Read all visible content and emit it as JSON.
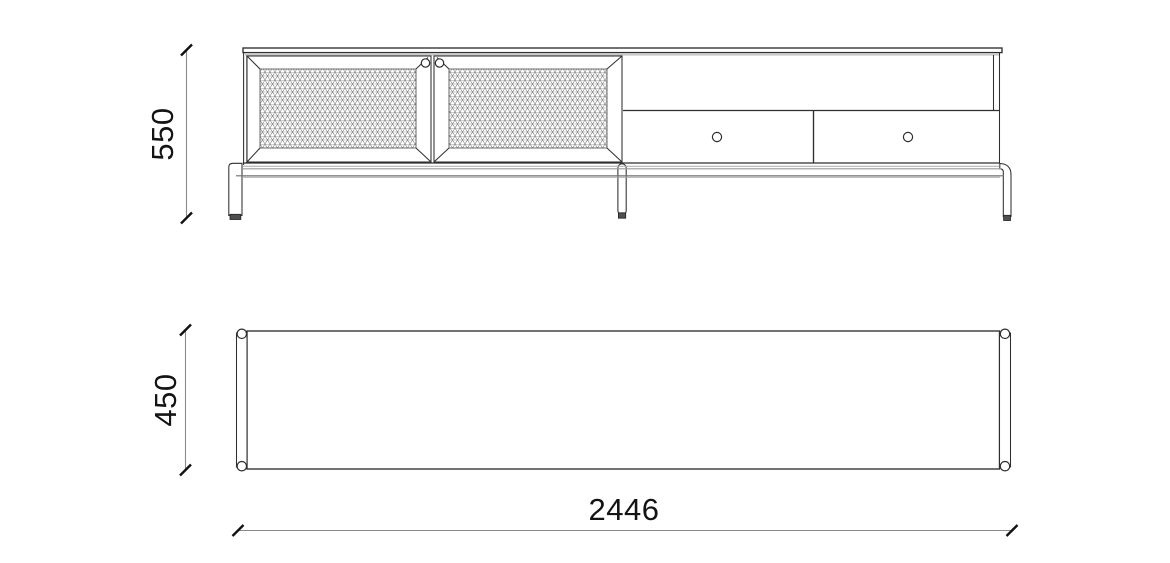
{
  "diagram": {
    "type": "furniture-technical-drawing",
    "views": {
      "front_elevation": {
        "name": "front elevation",
        "height_dimension": "550"
      },
      "plan": {
        "name": "top plan view",
        "depth_dimension": "450",
        "width_dimension": "2446"
      }
    },
    "colors": {
      "background": "#ffffff",
      "line_dark": "#2f2f2f",
      "line_medium": "#6f6f6f",
      "line_light": "#a9a9a9",
      "rail_top": "#9a9a9a",
      "dimension_line": "#8a8a8a",
      "tick": "#111111",
      "text": "#141414",
      "foot_cap": "#4f4f4f"
    }
  }
}
